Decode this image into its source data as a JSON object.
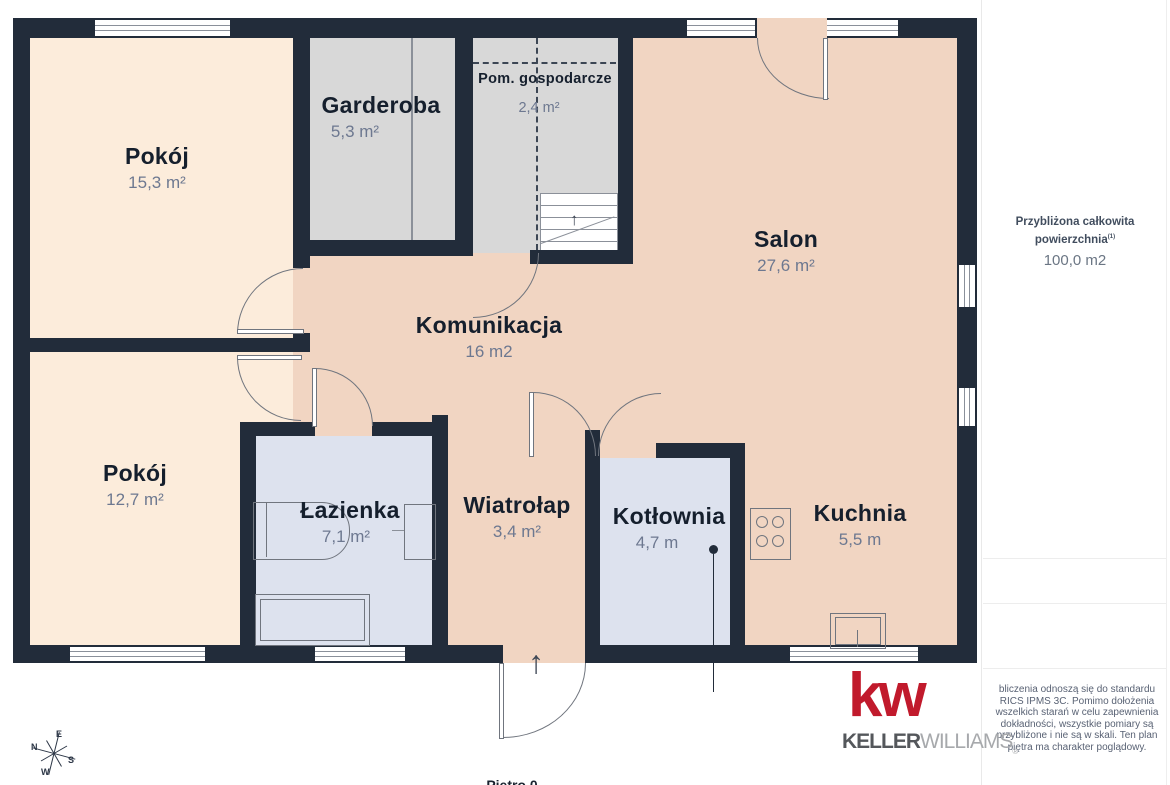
{
  "plan": {
    "rooms": [
      {
        "name": "Pokój",
        "area": "15,3 m²"
      },
      {
        "name": "Pokój",
        "area": "12,7 m²"
      },
      {
        "name": "Garderoba",
        "area": "5,3 m²"
      },
      {
        "name": "Pom. gospodarcze",
        "area": "2,4 m²"
      },
      {
        "name": "Komunikacja",
        "area": "16 m2"
      },
      {
        "name": "Salon",
        "area": "27,6 m²"
      },
      {
        "name": "Łazienka",
        "area": "7,1 m²"
      },
      {
        "name": "Wiatrołap",
        "area": "3,4 m²"
      },
      {
        "name": "Kotłownia",
        "area": "4,7 m"
      },
      {
        "name": "Kuchnia",
        "area": "5,5 m"
      }
    ],
    "floor_label": "Piętro 0",
    "compass": {
      "n": "N",
      "e": "E",
      "s": "S",
      "w": "W"
    },
    "entrance_arrow": "↑",
    "stairs_arrow": "↑"
  },
  "sidebar": {
    "total_area_title_line1": "Przybliżona całkowita",
    "total_area_title_line2": "powierzchnia",
    "total_area_title_superscript": "(1)",
    "total_area_value": "100,0 m2",
    "disclaimer_lines": [
      "bliczenia odnoszą się do standardu",
      "RICS IPMS 3C. Pomimo dołożenia",
      "wszelkich starań w celu zapewnienia",
      "dokładności, wszystkie pomiary są",
      "przybliżone i nie są w skali. Ten plan",
      "piętra ma charakter poglądowy."
    ]
  },
  "branding": {
    "logo_mark": "kw",
    "logo_name_bold": "KELLER",
    "logo_name_light": "WILLIAMS",
    "registered": "®"
  },
  "colors": {
    "wall": "#222c3a",
    "room_cream": "#fcecdb",
    "room_peach": "#f1d5c2",
    "room_gray": "#d8d8d8",
    "room_blue": "#dde2ee",
    "kw_red": "#c11a2c",
    "label_dark": "#151f2d",
    "label_muted": "#6d7890"
  }
}
